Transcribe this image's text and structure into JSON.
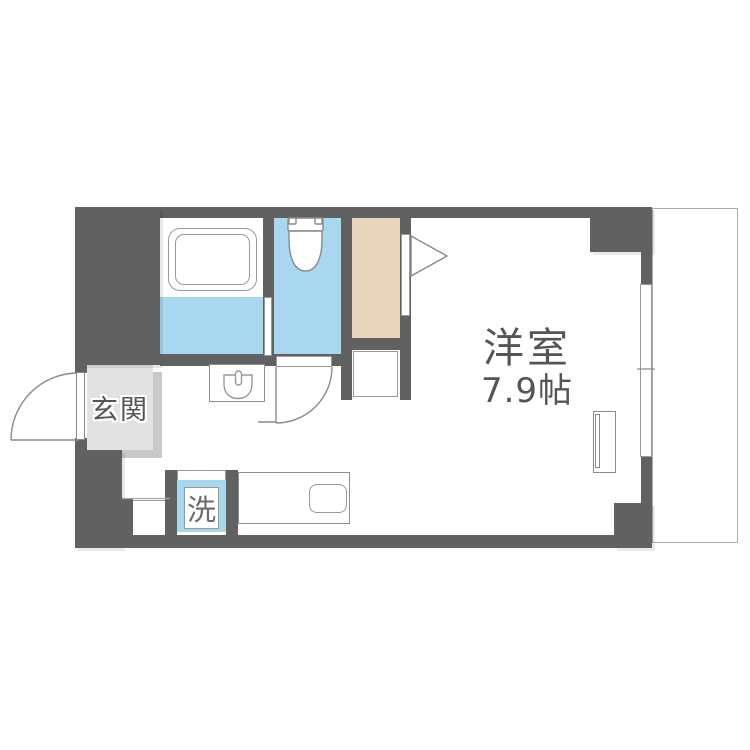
{
  "floorplan": {
    "rooms": {
      "western": {
        "name": "洋室",
        "size": "7.9帖"
      },
      "entrance": {
        "name": "玄関"
      }
    },
    "fixtures": {
      "washer_label": "洗"
    },
    "colors": {
      "wall": "#616161",
      "wet_area_blue": "#a8d8f0",
      "closet_beige": "#e8d5bd",
      "entrance_floor": "#e2e2e2",
      "entrance_floor_shadow": "#c9c9c9",
      "fixture_outline": "#999999",
      "label_text": "#555555"
    }
  }
}
